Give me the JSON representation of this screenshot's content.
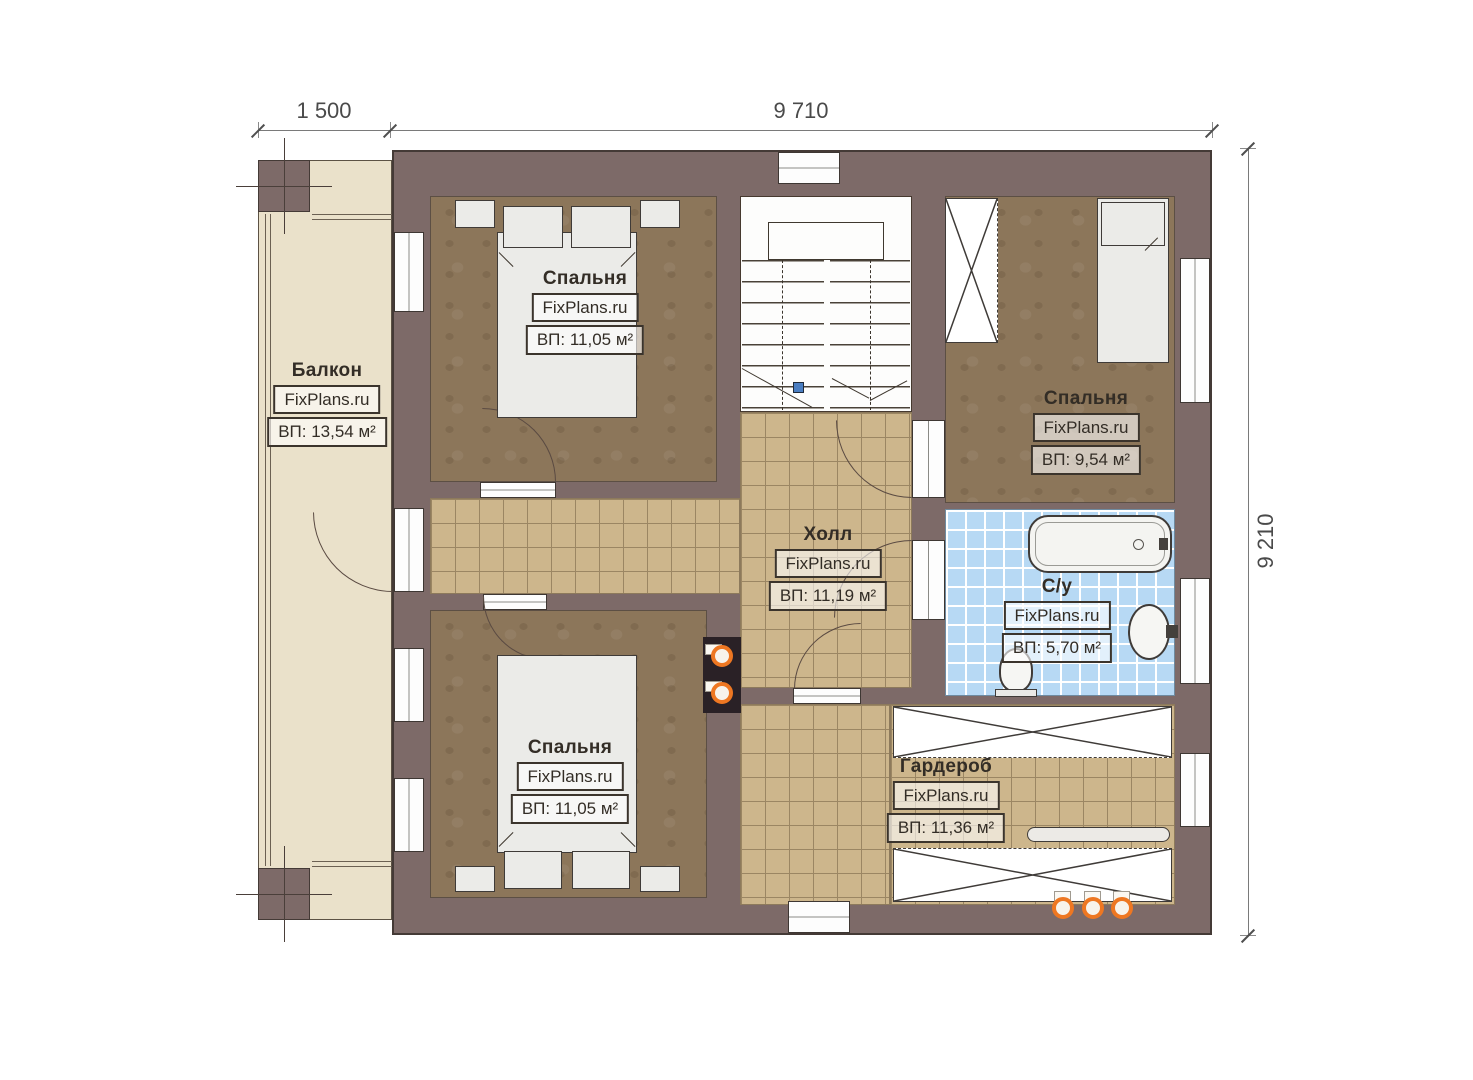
{
  "dimensions": {
    "top_left": "1 500",
    "top_right": "9 710",
    "right": "9 210"
  },
  "rooms": {
    "balcony": {
      "name": "Балкон",
      "watermark": "FixPlans.ru",
      "area": "ВП: 13,54 м²"
    },
    "bedroom_tl": {
      "name": "Спальня",
      "watermark": "FixPlans.ru",
      "area": "ВП: 11,05 м²"
    },
    "bedroom_tr": {
      "name": "Спальня",
      "watermark": "FixPlans.ru",
      "area": "ВП: 9,54 м²"
    },
    "hall": {
      "name": "Холл",
      "watermark": "FixPlans.ru",
      "area": "ВП: 11,19 м²"
    },
    "bathroom": {
      "name": "С/у",
      "watermark": "FixPlans.ru",
      "area": "ВП: 5,70 м²"
    },
    "bedroom_bl": {
      "name": "Спальня",
      "watermark": "FixPlans.ru",
      "area": "ВП: 11,05 м²"
    },
    "wardrobe": {
      "name": "Гардероб",
      "watermark": "FixPlans.ru",
      "area": "ВП: 11,36 м²"
    }
  },
  "colors": {
    "wall": "#7d6a68",
    "hall_tile": "#cdb68c",
    "bath_tile": "#b7d9f4",
    "bedroom_floor": "#8c765a",
    "balcony_floor": "#eae1ca",
    "pipe_accent": "#ee7722"
  }
}
